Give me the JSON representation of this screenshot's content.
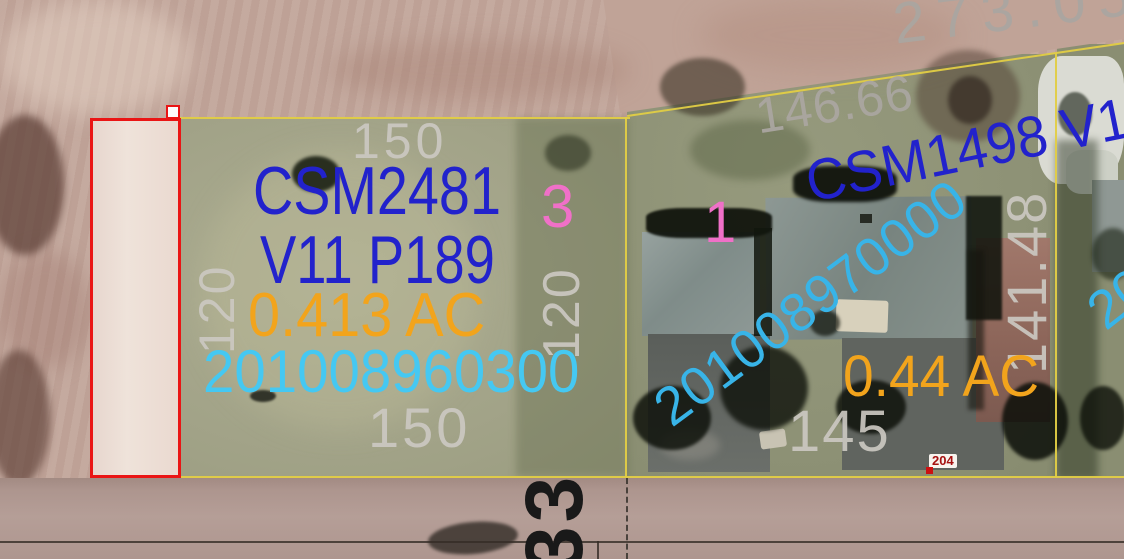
{
  "map": {
    "description": "county GIS aerial parcel map",
    "parcel_a": {
      "lot_number": "3",
      "csm_label": "CSM2481",
      "volume_page": "V11 P189",
      "acreage": "0.413 AC",
      "parcel_id": "201008960300",
      "dim_north": "150",
      "dim_south": "150",
      "dim_west": "120",
      "dim_east": "120"
    },
    "parcel_b": {
      "lot_number": "1",
      "csm_label_partial": "CSM1498 V1",
      "acreage": "0.44 AC",
      "parcel_id": "201008970000",
      "dim_north": "146.66",
      "dim_east": "141.48",
      "dim_south": "145",
      "address_point": "204"
    },
    "parcel_c": {
      "parcel_id_partial": "2010"
    },
    "north_field": {
      "dim_partial": "273.05"
    },
    "road": {
      "route_number": "33"
    },
    "colors": {
      "csm_blue": "#2222cc",
      "parcel_id_cyan": "#45c8f2",
      "acreage_orange": "#f2a41c",
      "lot_pink": "#f070c8",
      "dimension_gray": "#b9b6b0",
      "boundary_yellow": "#e2ce45",
      "selection_red": "#ea1515",
      "address_red": "#a51111",
      "route_black": "#191919"
    }
  }
}
